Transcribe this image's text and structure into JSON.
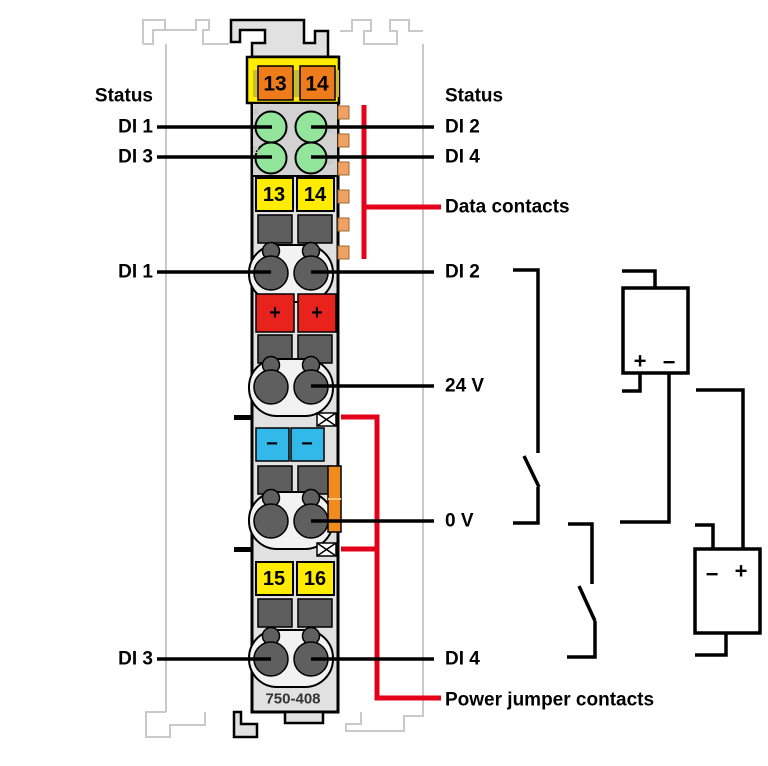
{
  "diagram": {
    "module": {
      "part_number": "750-408",
      "power_contacts_top": [
        "13",
        "14"
      ],
      "terminal_numbers_top": [
        "13",
        "14"
      ],
      "terminal_numbers_bottom": [
        "15",
        "16"
      ],
      "led_channel_letters": [
        "A",
        "B",
        "C",
        "D"
      ],
      "plus_terminal": "+",
      "minus_terminal": "−"
    },
    "labels_left": {
      "status": "Status",
      "di1_led": "DI 1",
      "di3_led": "DI 3",
      "di1_terminal": "DI 1",
      "di3_terminal": "DI 3"
    },
    "labels_right": {
      "status": "Status",
      "di2_led": "DI 2",
      "di4_led": "DI 4",
      "data_contacts": "Data contacts",
      "di2_terminal": "DI 2",
      "supply_24v": "24 V",
      "supply_0v": "0 V",
      "di4_terminal": "DI 4",
      "power_jumper_contacts": "Power jumper contacts"
    },
    "external_circuit": {
      "supply_upper": {
        "plus": "+",
        "minus": "−"
      },
      "supply_lower": {
        "minus": "−",
        "plus": "+"
      }
    },
    "colors": {
      "annotation_red": "#e3001b",
      "module_yellow": "#ffec00",
      "contact_orange": "#ef7c1a",
      "led_green": "#93e59c",
      "plus_red": "#e8231d",
      "minus_blue": "#32b8e9",
      "data_contact_tan": "#f0a263",
      "power_jumper_orange": "#f08c1e"
    }
  }
}
